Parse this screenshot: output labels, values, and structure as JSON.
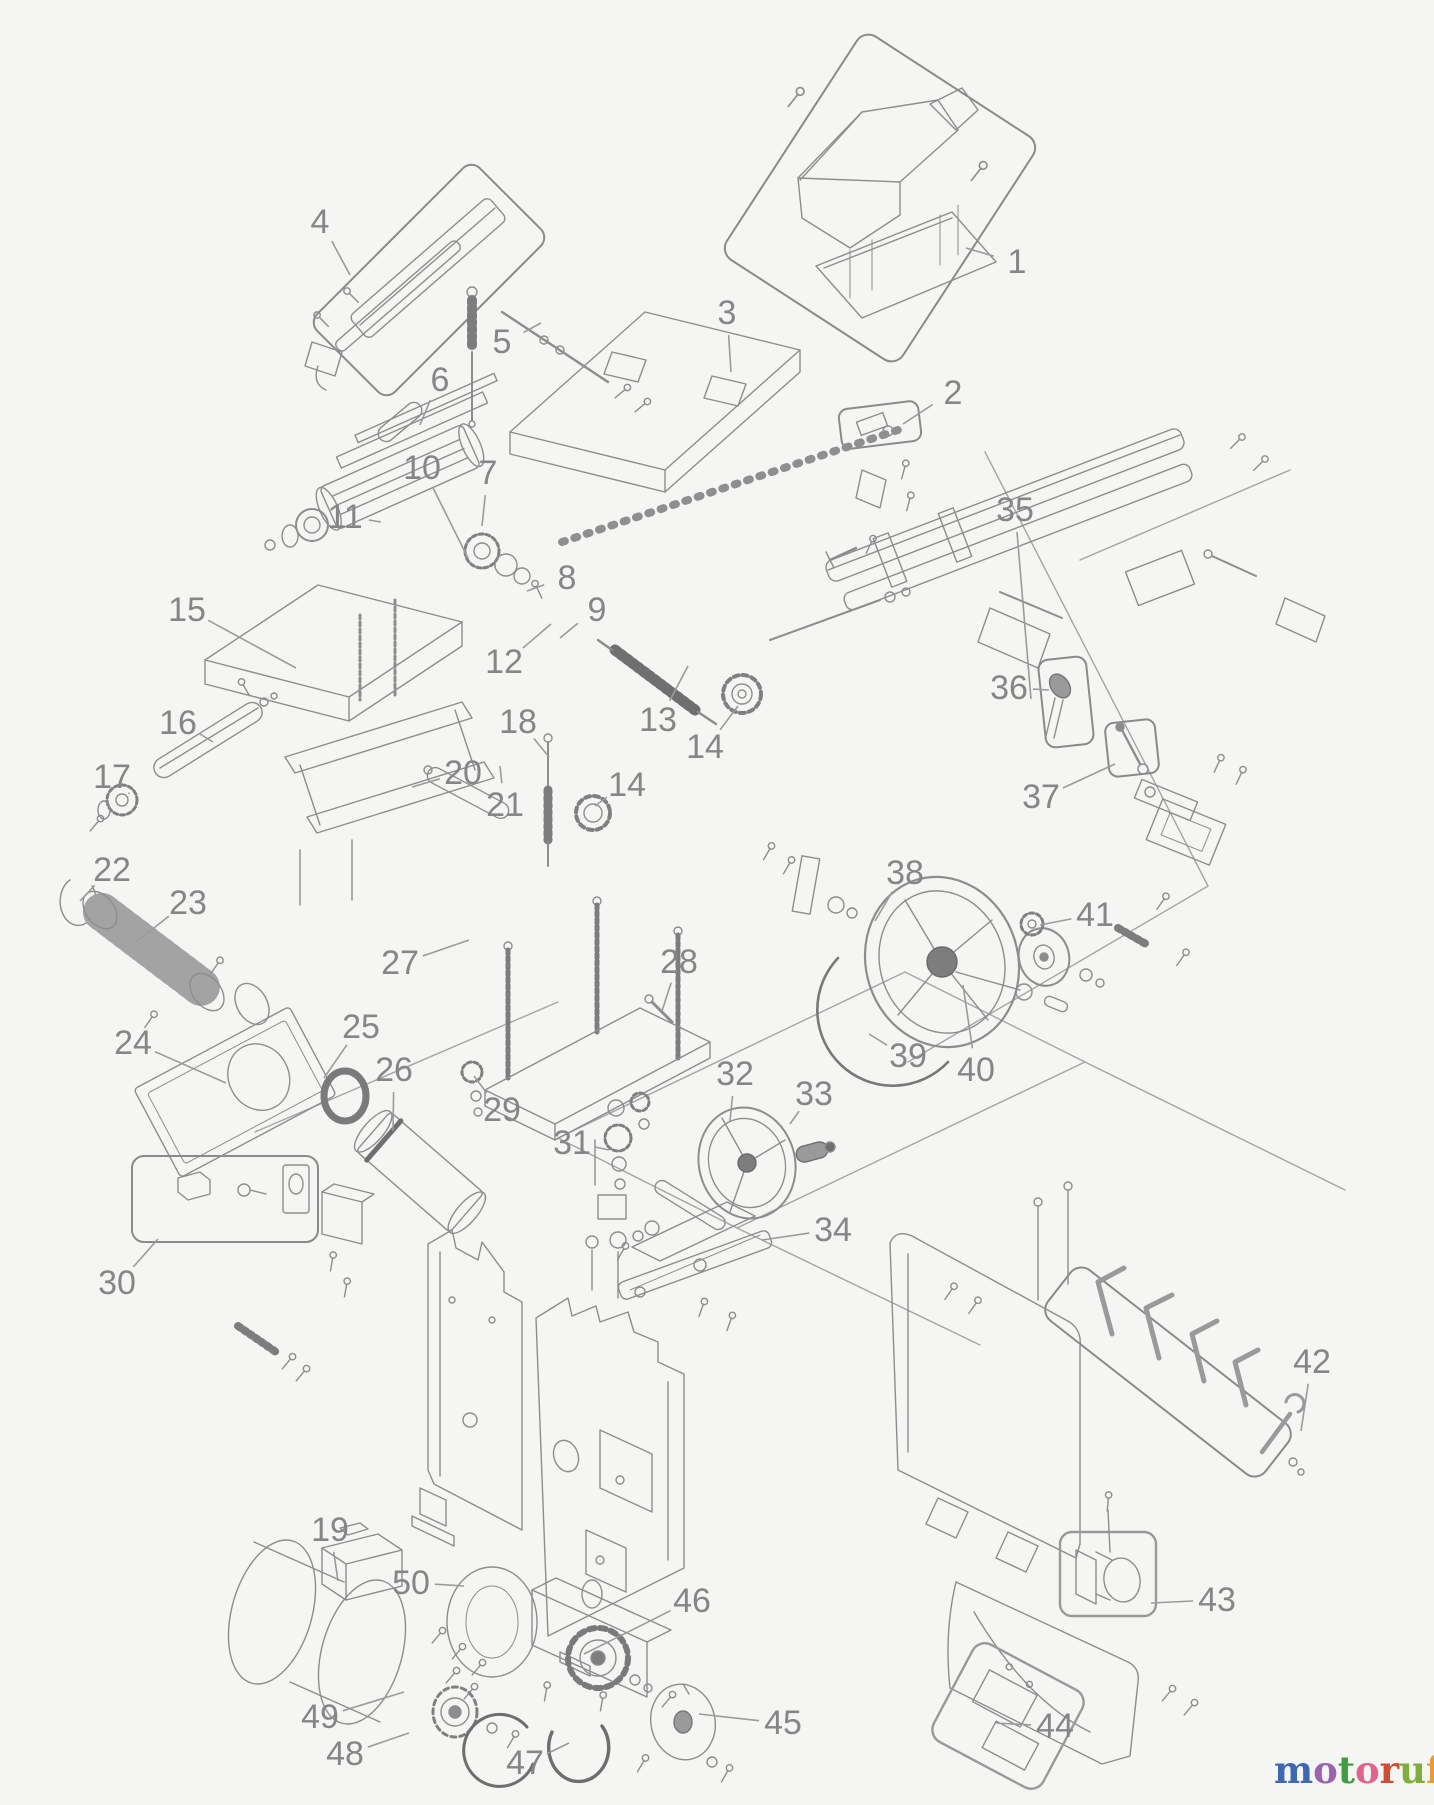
{
  "figure": {
    "type": "exploded-parts-diagram",
    "background": "#f5f5f3",
    "line_color": "#8d8d8d",
    "callout_color": "#868686",
    "leader_color": "#9b9b9b"
  },
  "callouts": [
    {
      "n": "1",
      "x": 1017,
      "y": 262,
      "tx": 966,
      "ty": 248
    },
    {
      "n": "2",
      "x": 953,
      "y": 393,
      "tx": 903,
      "ty": 424
    },
    {
      "n": "3",
      "x": 727,
      "y": 313,
      "tx": 731,
      "ty": 372
    },
    {
      "n": "4",
      "x": 320,
      "y": 222,
      "tx": 350,
      "ty": 275
    },
    {
      "n": "5",
      "x": 502,
      "y": 342,
      "tx": 541,
      "ty": 323
    },
    {
      "n": "6",
      "x": 440,
      "y": 380,
      "tx": 420,
      "ty": 425
    },
    {
      "n": "7",
      "x": 488,
      "y": 473,
      "tx": 482,
      "ty": 526
    },
    {
      "n": "8",
      "x": 567,
      "y": 578,
      "tx": 527,
      "ty": 591
    },
    {
      "n": "9",
      "x": 597,
      "y": 610,
      "tx": 560,
      "ty": 638
    },
    {
      "n": "10",
      "x": 422,
      "y": 468,
      "tx": 468,
      "ty": 558
    },
    {
      "n": "11",
      "x": 345,
      "y": 517,
      "tx": 381,
      "ty": 522
    },
    {
      "n": "12",
      "x": 504,
      "y": 662,
      "tx": 551,
      "ty": 624
    },
    {
      "n": "13",
      "x": 658,
      "y": 720,
      "tx": 688,
      "ty": 666
    },
    {
      "n": "14",
      "x": 705,
      "y": 747,
      "tx": 738,
      "ty": 706
    },
    {
      "n": "14",
      "x": 627,
      "y": 785,
      "tx": 595,
      "ty": 806
    },
    {
      "n": "15",
      "x": 187,
      "y": 610,
      "tx": 296,
      "ty": 668
    },
    {
      "n": "16",
      "x": 178,
      "y": 723,
      "tx": 213,
      "ty": 742
    },
    {
      "n": "17",
      "x": 112,
      "y": 777,
      "tx": 129,
      "ty": 794
    },
    {
      "n": "18",
      "x": 518,
      "y": 722,
      "tx": 549,
      "ty": 757
    },
    {
      "n": "19",
      "x": 330,
      "y": 1530,
      "tx": 338,
      "ty": 1581
    },
    {
      "n": "20",
      "x": 463,
      "y": 773,
      "tx": 412,
      "ty": 787
    },
    {
      "n": "21",
      "x": 505,
      "y": 805,
      "tx": 500,
      "ty": 766
    },
    {
      "n": "22",
      "x": 112,
      "y": 870,
      "tx": 80,
      "ty": 901
    },
    {
      "n": "23",
      "x": 188,
      "y": 903,
      "tx": 136,
      "ty": 942
    },
    {
      "n": "24",
      "x": 133,
      "y": 1043,
      "tx": 226,
      "ty": 1083
    },
    {
      "n": "25",
      "x": 361,
      "y": 1027,
      "tx": 324,
      "ty": 1078
    },
    {
      "n": "26",
      "x": 394,
      "y": 1070,
      "tx": 393,
      "ty": 1131
    },
    {
      "n": "27",
      "x": 400,
      "y": 963,
      "tx": 469,
      "ty": 940
    },
    {
      "n": "28",
      "x": 679,
      "y": 962,
      "tx": 662,
      "ty": 1011
    },
    {
      "n": "29",
      "x": 502,
      "y": 1110,
      "tx": 474,
      "ty": 1076
    },
    {
      "n": "30",
      "x": 117,
      "y": 1283,
      "tx": 158,
      "ty": 1239
    },
    {
      "n": "31",
      "x": 572,
      "y": 1143,
      "tx": 609,
      "ty": 1150
    },
    {
      "n": "32",
      "x": 735,
      "y": 1074,
      "tx": 730,
      "ty": 1121
    },
    {
      "n": "33",
      "x": 814,
      "y": 1094,
      "tx": 790,
      "ty": 1124
    },
    {
      "n": "34",
      "x": 833,
      "y": 1230,
      "tx": 762,
      "ty": 1240
    },
    {
      "n": "35",
      "x": 1015,
      "y": 510,
      "tx": 1031,
      "ty": 699
    },
    {
      "n": "36",
      "x": 1009,
      "y": 688,
      "tx": 1049,
      "ty": 690
    },
    {
      "n": "37",
      "x": 1041,
      "y": 797,
      "tx": 1115,
      "ty": 764
    },
    {
      "n": "38",
      "x": 905,
      "y": 873,
      "tx": 875,
      "ty": 921
    },
    {
      "n": "39",
      "x": 908,
      "y": 1056,
      "tx": 869,
      "ty": 1034
    },
    {
      "n": "40",
      "x": 976,
      "y": 1070,
      "tx": 963,
      "ty": 985
    },
    {
      "n": "41",
      "x": 1095,
      "y": 915,
      "tx": 1040,
      "ty": 925
    },
    {
      "n": "42",
      "x": 1312,
      "y": 1362,
      "tx": 1301,
      "ty": 1431
    },
    {
      "n": "43",
      "x": 1217,
      "y": 1600,
      "tx": 1151,
      "ty": 1603
    },
    {
      "n": "44",
      "x": 1055,
      "y": 1726,
      "tx": 996,
      "ty": 1723
    },
    {
      "n": "45",
      "x": 783,
      "y": 1723,
      "tx": 699,
      "ty": 1714
    },
    {
      "n": "46",
      "x": 692,
      "y": 1601,
      "tx": 584,
      "ty": 1654
    },
    {
      "n": "47",
      "x": 525,
      "y": 1763,
      "tx": 569,
      "ty": 1743
    },
    {
      "n": "48",
      "x": 345,
      "y": 1754,
      "tx": 409,
      "ty": 1733
    },
    {
      "n": "49",
      "x": 320,
      "y": 1717,
      "tx": 404,
      "ty": 1692
    },
    {
      "n": "50",
      "x": 411,
      "y": 1583,
      "tx": 464,
      "ty": 1586
    }
  ],
  "watermark": {
    "letters": [
      {
        "ch": "m",
        "color": "#3e68b0"
      },
      {
        "ch": "o",
        "color": "#9a62b3"
      },
      {
        "ch": "t",
        "color": "#3f9c45"
      },
      {
        "ch": "o",
        "color": "#e06390"
      },
      {
        "ch": "r",
        "color": "#cd4f35"
      },
      {
        "ch": "u",
        "color": "#7fae3d"
      },
      {
        "ch": "f",
        "color": "#e89b3a"
      }
    ],
    "tm_mark": "'",
    "tm_color": "#e89b3a",
    "suffix": ".de",
    "suffix_color": "#4a4a4a"
  }
}
